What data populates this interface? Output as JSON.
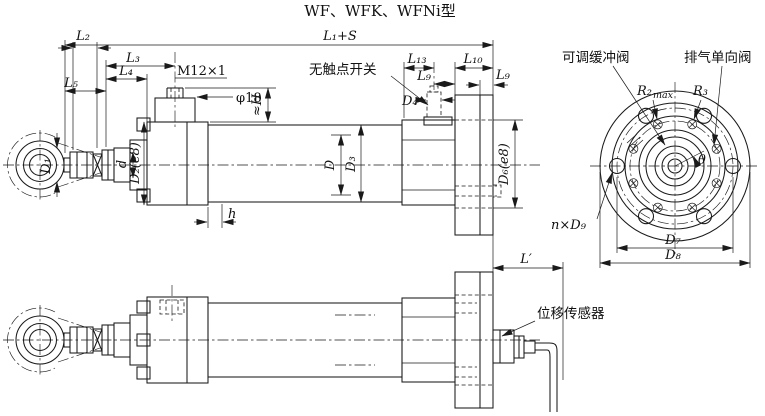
{
  "title": "WF、WFK、WFNi型",
  "colors": {
    "line_color": "#1a1a1a",
    "background": "#ffffff"
  },
  "side_view": {
    "dims": {
      "l1_plus_s": "L₁+S",
      "l2": "L₂",
      "l3": "L₃",
      "l4": "L₄",
      "l5": "L₅",
      "m12_thread": "M12×1",
      "phi18": "φ18",
      "h_height": "≈H",
      "l13": "L₁₃",
      "l9_left": "L₉",
      "l10": "L₁₀",
      "l9_right": "L₉",
      "d4": "D₄",
      "d1": "D₁",
      "d_rod": "d",
      "d2": "D₂(e8)",
      "d_bore": "D",
      "d3": "D₃",
      "d6": "D₆(e8)",
      "h_spigot": "h"
    },
    "callouts": {
      "contactless_switch": "无触点开关"
    }
  },
  "end_view": {
    "callouts": {
      "cushion_valve": "可调缓冲阀",
      "exhaust_valve": "排气单向阀"
    },
    "dims": {
      "r2": "R₂",
      "r2_sub": "max",
      "r3": "R₃",
      "theta": "θ",
      "n_x_d9": "n×D₉",
      "d7": "D₇",
      "d8": "D₈"
    }
  },
  "bottom_view": {
    "dims": {
      "l_prime": "L′"
    },
    "callouts": {
      "displacement_sensor": "位移传感器"
    }
  }
}
